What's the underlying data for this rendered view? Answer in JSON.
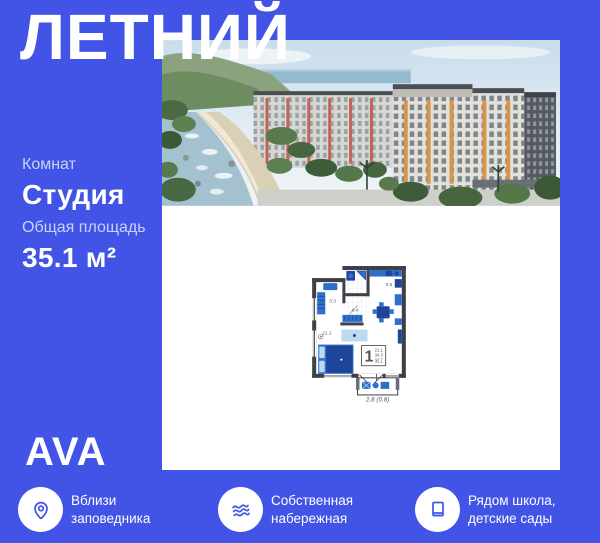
{
  "theme": {
    "bg_blue": "#4254E6",
    "accent_blue": "#4254E6",
    "muted_label_color": "#C9D2F6",
    "plan_wall_color": "#3F4046",
    "plan_furniture_blue": "#2F6FCC",
    "plan_furniture_dark_blue": "#1D4599",
    "plan_light_blue": "#BFD9F0"
  },
  "header": {
    "title": "ЛЕТНИЙ"
  },
  "photo": {
    "description": "residential-complex-render"
  },
  "specs": [
    {
      "label": "Комнат",
      "value": "Студия"
    },
    {
      "label": "Общая площадь",
      "value": "35.1 м²"
    }
  ],
  "floor_plan": {
    "rooms": [
      {
        "name": "wardrobe-room",
        "area": "3.3"
      },
      {
        "name": "kitchen",
        "area": "5.5"
      },
      {
        "name": "hallway",
        "area": "4.4"
      },
      {
        "name": "living-room",
        "area": "21.1"
      }
    ],
    "summary": {
      "rooms_count": "1",
      "living_area": "21.1",
      "area_without_balcony": "34.3",
      "total_area": "35.1"
    },
    "balcony_area": "2.8 (0.8)"
  },
  "brand": {
    "logo": "AVA"
  },
  "features": [
    {
      "icon": "location-pin-icon",
      "line1": "Вблизи",
      "line2": "заповедника"
    },
    {
      "icon": "waves-icon",
      "line1": "Собственная",
      "line2": "набережная"
    },
    {
      "icon": "book-icon",
      "line1": "Рядом школа,",
      "line2": "детские сады"
    }
  ]
}
